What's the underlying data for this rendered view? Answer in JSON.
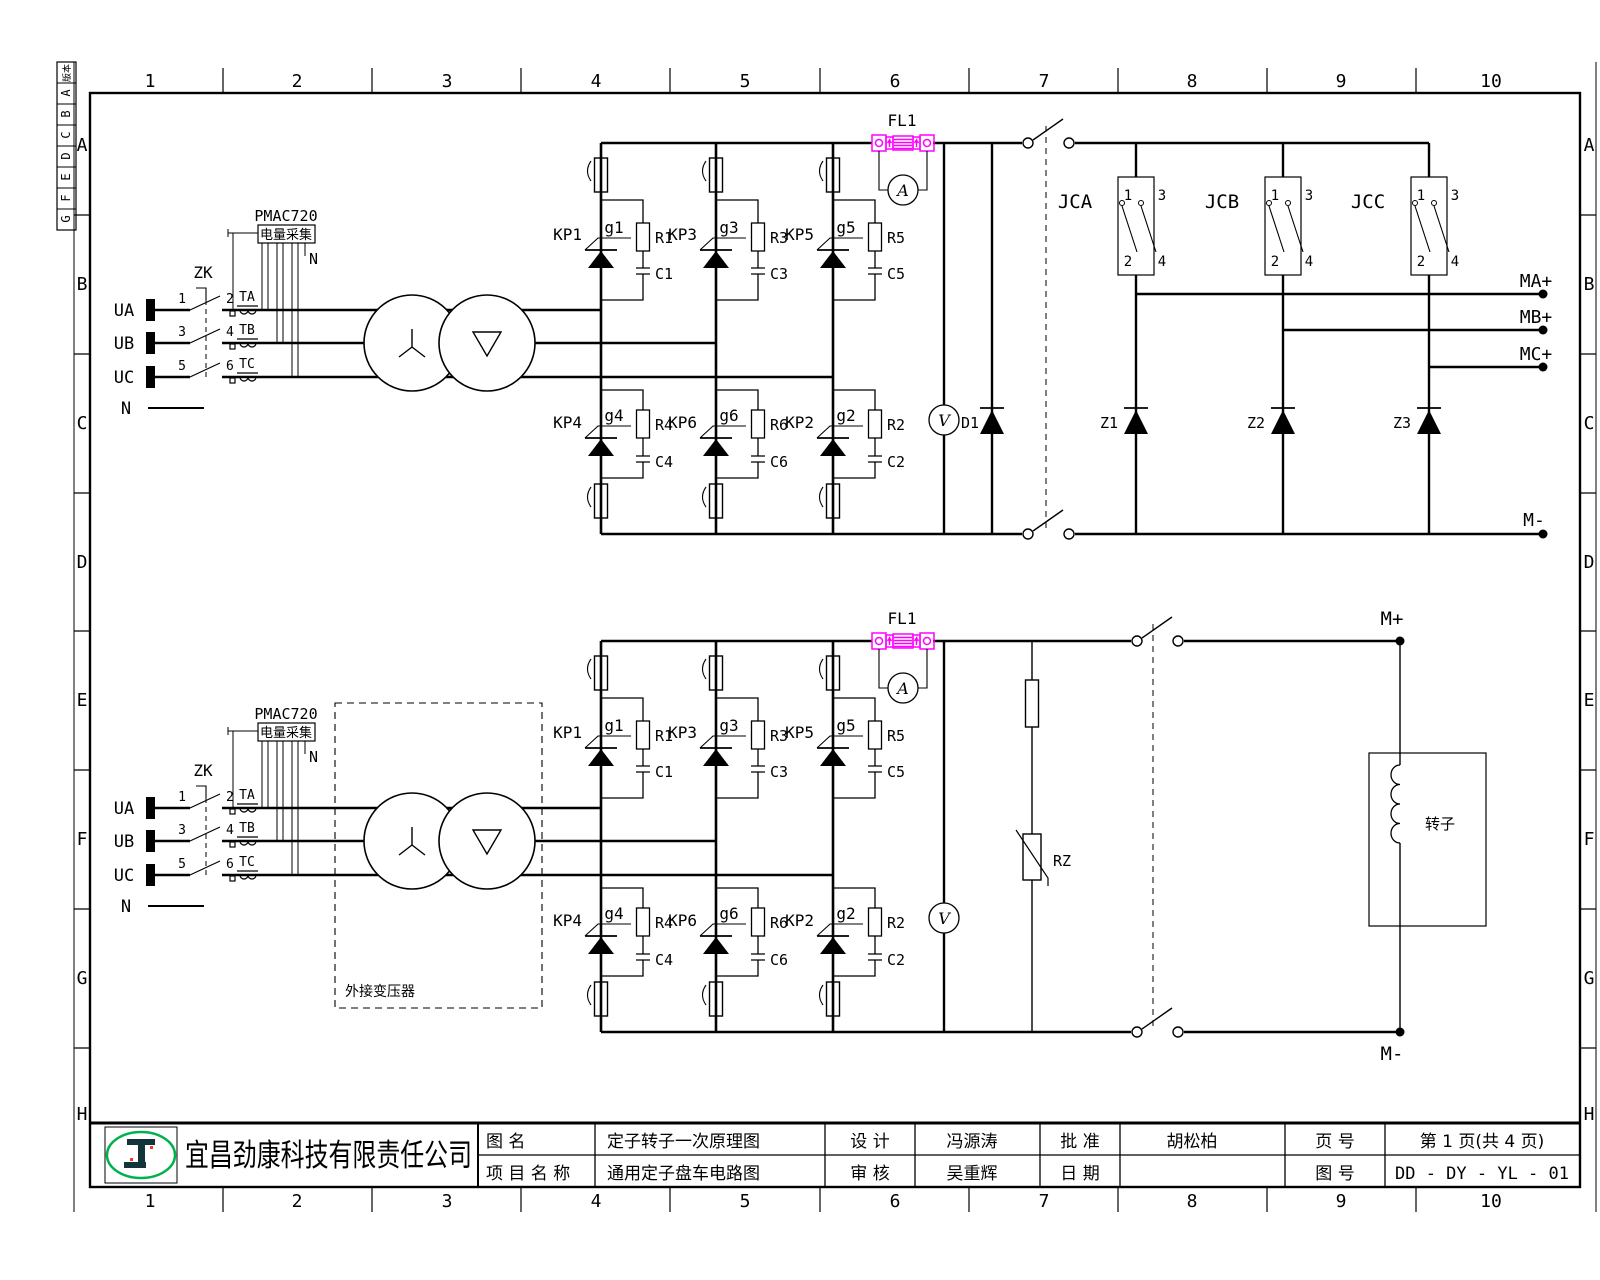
{
  "frame": {
    "columns": [
      "1",
      "2",
      "3",
      "4",
      "5",
      "6",
      "7",
      "8",
      "9",
      "10"
    ],
    "rows": [
      "A",
      "B",
      "C",
      "D",
      "E",
      "F",
      "G",
      "H"
    ],
    "revision": {
      "header": "版本",
      "letters": [
        "A",
        "B",
        "C",
        "D",
        "E",
        "F",
        "G"
      ]
    }
  },
  "circuit": {
    "phase_labels": [
      "UA",
      "UB",
      "UC"
    ],
    "neutral_label": "N",
    "breaker_label": "ZK",
    "pole_numbers_left": [
      "1",
      "3",
      "5"
    ],
    "pole_numbers_right": [
      "2",
      "4",
      "6"
    ],
    "ct_labels": [
      "TA",
      "TB",
      "TC"
    ],
    "meter_module_label": "PMAC720",
    "meter_module_text": "电量采集",
    "meter_neutral_label": "N",
    "shunt_label": "FL1",
    "ammeter_letter": "A",
    "voltmeter_letter": "V",
    "thyristors_top": [
      "KP1",
      "KP3",
      "KP5"
    ],
    "gates_top": [
      "g1",
      "g3",
      "g5"
    ],
    "resistors_top": [
      "R1",
      "R3",
      "R5"
    ],
    "capacitors_top": [
      "C1",
      "C3",
      "C5"
    ],
    "thyristors_bottom": [
      "KP4",
      "KP6",
      "KP2"
    ],
    "gates_bottom": [
      "g4",
      "g6",
      "g2"
    ],
    "resistors_bottom": [
      "R4",
      "R6",
      "R2"
    ],
    "capacitors_bottom": [
      "C4",
      "C6",
      "C2"
    ]
  },
  "upper": {
    "freewheel_diode": "D1",
    "relays": [
      "JCA",
      "JCB",
      "JCC"
    ],
    "relay_pins": {
      "p1": "1",
      "p3": "3",
      "p2": "2",
      "p4": "4"
    },
    "z_diodes": [
      "Z1",
      "Z2",
      "Z3"
    ],
    "outputs": [
      "MA+",
      "MB+",
      "MC+"
    ],
    "negative": "M-"
  },
  "lower": {
    "ext_transformer": "外接变压器",
    "varistor": "RZ",
    "motor_pos": "M+",
    "motor_neg": "M-",
    "rotor": "转子"
  },
  "title_block": {
    "company": "宜昌劲康科技有限责任公司",
    "drawing_label": "图        名",
    "drawing_name": "定子转子一次原理图",
    "project_label": "项 目 名 称",
    "project_name": "通用定子盘车电路图",
    "design_label": "设  计",
    "designer": "冯源涛",
    "check_label": "审  核",
    "checker": "吴重辉",
    "approve_label": "批  准",
    "approver": "胡松柏",
    "date_label": "日  期",
    "date_value": "",
    "page_label": "页  号",
    "page_value": "第 1 页(共 4 页)",
    "number_label": "图  号",
    "number_value": "DD - DY - YL - 01"
  },
  "colors": {
    "line": "#000000",
    "shunt": "#ff00ff",
    "logo": "#00b14c"
  }
}
